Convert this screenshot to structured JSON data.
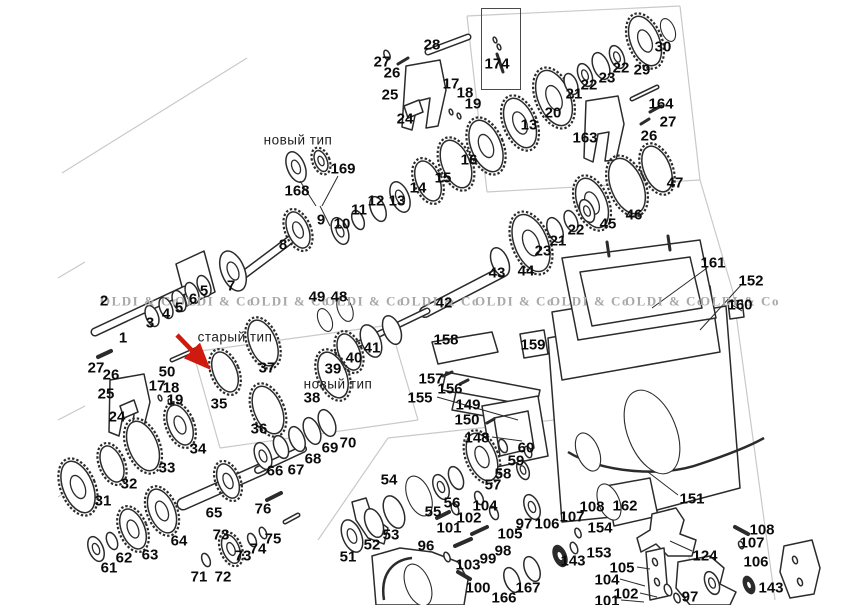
{
  "figure": {
    "width": 863,
    "height": 605,
    "background": "#ffffff",
    "line_color": "#2b2b2b",
    "label_color": "#0b0b0b",
    "watermark_color": "#a8a8a8",
    "section_line_color": "#c9c9c9",
    "arrow_color": "#cf1a10"
  },
  "watermark": {
    "text": "OLDI & Co",
    "y": 301,
    "xs": [
      100,
      175,
      250,
      325,
      400,
      475,
      550,
      625,
      700
    ]
  },
  "annotations": [
    {
      "text": "новый тип",
      "x": 298,
      "y": 140
    },
    {
      "text": "старый тип",
      "x": 235,
      "y": 337
    },
    {
      "text": "новый тип",
      "x": 338,
      "y": 384
    }
  ],
  "inset_box": {
    "part": "174",
    "x": 481,
    "y": 8,
    "w": 38,
    "h": 80
  },
  "red_arrow": {
    "x1": 177,
    "y1": 335,
    "x2": 205,
    "y2": 364
  },
  "callouts": [
    [
      "1",
      123,
      338
    ],
    [
      "2",
      104,
      301
    ],
    [
      "3",
      150,
      323
    ],
    [
      "4",
      166,
      314
    ],
    [
      "5",
      179,
      308
    ],
    [
      "6",
      193,
      299
    ],
    [
      "5",
      204,
      291
    ],
    [
      "7",
      231,
      286
    ],
    [
      "8",
      283,
      245
    ],
    [
      "168",
      297,
      191
    ],
    [
      "169",
      343,
      169
    ],
    [
      "9",
      321,
      220
    ],
    [
      "10",
      342,
      224
    ],
    [
      "11",
      359,
      210
    ],
    [
      "12",
      376,
      201
    ],
    [
      "13",
      397,
      201
    ],
    [
      "14",
      418,
      188
    ],
    [
      "15",
      443,
      178
    ],
    [
      "16",
      469,
      160
    ],
    [
      "27",
      382,
      62
    ],
    [
      "26",
      392,
      73
    ],
    [
      "25",
      390,
      95
    ],
    [
      "24",
      405,
      119
    ],
    [
      "28",
      432,
      45
    ],
    [
      "17",
      451,
      84
    ],
    [
      "18",
      465,
      93
    ],
    [
      "19",
      473,
      104
    ],
    [
      "13",
      529,
      125
    ],
    [
      "20",
      553,
      113
    ],
    [
      "174",
      497,
      64
    ],
    [
      "21",
      574,
      94
    ],
    [
      "22",
      589,
      85
    ],
    [
      "23",
      607,
      78
    ],
    [
      "22",
      621,
      68
    ],
    [
      "29",
      642,
      70
    ],
    [
      "30",
      663,
      47
    ],
    [
      "164",
      661,
      104
    ],
    [
      "27",
      668,
      122
    ],
    [
      "26",
      649,
      136
    ],
    [
      "163",
      585,
      138
    ],
    [
      "47",
      675,
      183
    ],
    [
      "46",
      634,
      215
    ],
    [
      "45",
      608,
      224
    ],
    [
      "49",
      317,
      297
    ],
    [
      "48",
      339,
      297
    ],
    [
      "42",
      444,
      303
    ],
    [
      "43",
      497,
      273
    ],
    [
      "44",
      526,
      271
    ],
    [
      "23",
      543,
      251
    ],
    [
      "21",
      558,
      241
    ],
    [
      "22",
      576,
      230
    ],
    [
      "39",
      333,
      369
    ],
    [
      "40",
      354,
      358
    ],
    [
      "41",
      372,
      348
    ],
    [
      "35",
      219,
      404
    ],
    [
      "37",
      267,
      368
    ],
    [
      "36",
      259,
      429
    ],
    [
      "38",
      312,
      398
    ],
    [
      "27",
      96,
      368
    ],
    [
      "26",
      111,
      375
    ],
    [
      "50",
      167,
      372
    ],
    [
      "25",
      106,
      394
    ],
    [
      "24",
      117,
      417
    ],
    [
      "17",
      157,
      386
    ],
    [
      "18",
      171,
      388
    ],
    [
      "19",
      175,
      400
    ],
    [
      "34",
      198,
      449
    ],
    [
      "33",
      167,
      468
    ],
    [
      "32",
      129,
      484
    ],
    [
      "31",
      103,
      501
    ],
    [
      "61",
      109,
      568
    ],
    [
      "62",
      124,
      558
    ],
    [
      "63",
      150,
      555
    ],
    [
      "64",
      179,
      541
    ],
    [
      "65",
      214,
      513
    ],
    [
      "66",
      275,
      471
    ],
    [
      "67",
      296,
      470
    ],
    [
      "68",
      313,
      459
    ],
    [
      "69",
      330,
      448
    ],
    [
      "70",
      348,
      443
    ],
    [
      "71",
      199,
      577
    ],
    [
      "72",
      223,
      577
    ],
    [
      "73",
      221,
      535
    ],
    [
      "73",
      243,
      556
    ],
    [
      "74",
      258,
      549
    ],
    [
      "75",
      273,
      539
    ],
    [
      "76",
      263,
      509
    ],
    [
      "51",
      348,
      557
    ],
    [
      "52",
      372,
      545
    ],
    [
      "53",
      391,
      535
    ],
    [
      "54",
      389,
      480
    ],
    [
      "55",
      433,
      512
    ],
    [
      "56",
      452,
      503
    ],
    [
      "57",
      493,
      485
    ],
    [
      "58",
      503,
      474
    ],
    [
      "96",
      426,
      546
    ],
    [
      "101",
      449,
      528
    ],
    [
      "102",
      469,
      518
    ],
    [
      "104",
      485,
      506
    ],
    [
      "105",
      510,
      534
    ],
    [
      "103",
      468,
      565
    ],
    [
      "99",
      488,
      559
    ],
    [
      "98",
      503,
      551
    ],
    [
      "100",
      478,
      588
    ],
    [
      "166",
      504,
      598
    ],
    [
      "167",
      528,
      588
    ],
    [
      "97",
      524,
      524
    ],
    [
      "106",
      547,
      524
    ],
    [
      "108",
      592,
      507
    ],
    [
      "107",
      572,
      517
    ],
    [
      "162",
      625,
      506
    ],
    [
      "151",
      692,
      499
    ],
    [
      "154",
      600,
      528
    ],
    [
      "153",
      599,
      553
    ],
    [
      "143",
      573,
      561
    ],
    [
      "105",
      622,
      568
    ],
    [
      "104",
      607,
      580
    ],
    [
      "102",
      626,
      594
    ],
    [
      "101",
      607,
      601
    ],
    [
      "124",
      705,
      556
    ],
    [
      "97",
      690,
      597
    ],
    [
      "108",
      762,
      530
    ],
    [
      "107",
      752,
      543
    ],
    [
      "106",
      756,
      562
    ],
    [
      "143",
      771,
      588
    ],
    [
      "158",
      446,
      340
    ],
    [
      "159",
      533,
      345
    ],
    [
      "157",
      431,
      379
    ],
    [
      "156",
      450,
      389
    ],
    [
      "155",
      420,
      398
    ],
    [
      "149",
      468,
      405
    ],
    [
      "150",
      467,
      420
    ],
    [
      "148",
      477,
      438
    ],
    [
      "60",
      526,
      448
    ],
    [
      "59",
      516,
      461
    ],
    [
      "161",
      713,
      263
    ],
    [
      "152",
      751,
      281
    ],
    [
      "160",
      740,
      305
    ]
  ],
  "drawing": {
    "rings": [
      [
        296,
        167,
        16,
        "b"
      ],
      [
        321,
        161,
        11,
        "g"
      ],
      [
        298,
        230,
        19,
        "g"
      ],
      [
        340,
        231,
        14,
        "b"
      ],
      [
        358,
        220,
        10,
        "r"
      ],
      [
        378,
        209,
        13,
        "r"
      ],
      [
        400,
        197,
        16,
        "b"
      ],
      [
        428,
        181,
        21,
        "t"
      ],
      [
        456,
        164,
        25,
        "t"
      ],
      [
        486,
        146,
        27,
        "g"
      ],
      [
        520,
        123,
        26,
        "g"
      ],
      [
        554,
        98,
        29,
        "g"
      ],
      [
        571,
        84,
        11,
        "r"
      ],
      [
        585,
        75,
        12,
        "b"
      ],
      [
        601,
        66,
        14,
        "r"
      ],
      [
        617,
        57,
        12,
        "b"
      ],
      [
        645,
        41,
        26,
        "g"
      ],
      [
        668,
        30,
        12,
        "n"
      ],
      [
        592,
        203,
        26,
        "g"
      ],
      [
        627,
        186,
        29,
        "t"
      ],
      [
        657,
        169,
        24,
        "t"
      ],
      [
        500,
        262,
        15,
        "r"
      ],
      [
        531,
        243,
        30,
        "g"
      ],
      [
        555,
        230,
        13,
        "r"
      ],
      [
        571,
        221,
        11,
        "r"
      ],
      [
        587,
        211,
        12,
        "b"
      ],
      [
        392,
        330,
        15,
        "r"
      ],
      [
        371,
        341,
        17,
        "r"
      ],
      [
        349,
        352,
        19,
        "t"
      ],
      [
        325,
        320,
        12,
        "n"
      ],
      [
        345,
        309,
        13,
        "n"
      ],
      [
        225,
        372,
        21,
        "t"
      ],
      [
        263,
        343,
        24,
        "t"
      ],
      [
        268,
        410,
        25,
        "t"
      ],
      [
        333,
        375,
        24,
        "t"
      ],
      [
        152,
        316,
        11,
        "r"
      ],
      [
        166,
        308,
        11,
        "r"
      ],
      [
        179,
        301,
        11,
        "r"
      ],
      [
        192,
        293,
        11,
        "r"
      ],
      [
        204,
        286,
        11,
        "r"
      ],
      [
        233,
        271,
        21,
        "b"
      ],
      [
        180,
        425,
        21,
        "g"
      ],
      [
        143,
        446,
        26,
        "t"
      ],
      [
        112,
        464,
        19,
        "t"
      ],
      [
        78,
        487,
        27,
        "g"
      ],
      [
        96,
        549,
        13,
        "b"
      ],
      [
        112,
        541,
        9,
        "r"
      ],
      [
        133,
        529,
        21,
        "g"
      ],
      [
        162,
        511,
        23,
        "g"
      ],
      [
        228,
        481,
        18,
        "g"
      ],
      [
        263,
        456,
        14,
        "b"
      ],
      [
        281,
        447,
        12,
        "r"
      ],
      [
        297,
        439,
        13,
        "r"
      ],
      [
        312,
        431,
        14,
        "r"
      ],
      [
        327,
        423,
        14,
        "r"
      ],
      [
        206,
        560,
        7,
        "r"
      ],
      [
        231,
        549,
        15,
        "g"
      ],
      [
        252,
        540,
        7,
        "r"
      ],
      [
        263,
        533,
        6,
        "r"
      ],
      [
        352,
        536,
        17,
        "b"
      ],
      [
        374,
        523,
        15,
        "r"
      ],
      [
        394,
        512,
        17,
        "r"
      ],
      [
        419,
        496,
        21,
        "n"
      ],
      [
        441,
        487,
        13,
        "b"
      ],
      [
        456,
        478,
        12,
        "r"
      ],
      [
        482,
        457,
        25,
        "g"
      ],
      [
        503,
        446,
        7,
        "r"
      ],
      [
        532,
        507,
        13,
        "b"
      ],
      [
        455,
        509,
        6,
        "r"
      ],
      [
        479,
        498,
        7,
        "r"
      ],
      [
        494,
        513,
        7,
        "r"
      ],
      [
        447,
        557,
        5,
        "r"
      ],
      [
        512,
        580,
        13,
        "r"
      ],
      [
        532,
        569,
        13,
        "r"
      ],
      [
        560,
        556,
        11,
        "d"
      ],
      [
        574,
        548,
        6,
        "r"
      ],
      [
        578,
        533,
        5,
        "r"
      ],
      [
        523,
        470,
        10,
        "b"
      ],
      [
        528,
        452,
        6,
        "r"
      ],
      [
        749,
        585,
        9,
        "d"
      ],
      [
        741,
        545,
        4,
        "r"
      ],
      [
        668,
        590,
        6,
        "r"
      ],
      [
        677,
        598,
        5,
        "r"
      ],
      [
        652,
        432,
        44,
        "n"
      ],
      [
        588,
        452,
        20,
        "n"
      ],
      [
        609,
        502,
        19,
        "n"
      ],
      [
        418,
        585,
        22,
        "n"
      ],
      [
        712,
        583,
        12,
        "b"
      ],
      [
        387,
        55,
        5,
        "r"
      ],
      [
        451,
        112,
        3,
        "r"
      ],
      [
        459,
        116,
        3,
        "r"
      ],
      [
        160,
        398,
        3,
        "r"
      ],
      [
        170,
        402,
        3,
        "r"
      ],
      [
        495,
        40,
        3,
        "r"
      ],
      [
        499,
        47,
        3,
        "r"
      ],
      [
        795,
        560,
        4,
        "r"
      ],
      [
        800,
        582,
        4,
        "r"
      ],
      [
        655,
        562,
        4,
        "r"
      ],
      [
        657,
        582,
        4,
        "r"
      ]
    ],
    "shafts": [
      [
        95,
        332,
        185,
        290,
        9
      ],
      [
        238,
        279,
        302,
        231,
        9
      ],
      [
        428,
        52,
        468,
        37,
        7
      ],
      [
        632,
        99,
        657,
        87,
        5
      ],
      [
        172,
        360,
        197,
        349,
        5
      ],
      [
        98,
        357,
        111,
        351,
        4
      ],
      [
        425,
        312,
        502,
        272,
        12
      ],
      [
        352,
        347,
        427,
        311,
        7
      ],
      [
        183,
        504,
        262,
        469,
        13
      ],
      [
        258,
        470,
        303,
        449,
        8
      ],
      [
        285,
        522,
        298,
        515,
        5
      ],
      [
        267,
        500,
        281,
        493,
        4
      ],
      [
        437,
        518,
        449,
        512,
        4
      ],
      [
        472,
        534,
        487,
        527,
        4
      ],
      [
        455,
        546,
        471,
        539,
        4
      ],
      [
        458,
        572,
        470,
        579,
        4
      ],
      [
        735,
        527,
        748,
        534,
        4
      ],
      [
        398,
        64,
        408,
        58,
        3
      ],
      [
        650,
        112,
        661,
        106,
        3
      ],
      [
        641,
        124,
        649,
        119,
        3
      ],
      [
        443,
        376,
        452,
        372,
        3
      ],
      [
        460,
        384,
        468,
        380,
        3
      ],
      [
        487,
        423,
        494,
        419,
        3
      ],
      [
        497,
        54,
        503,
        72,
        3
      ],
      [
        607,
        242,
        609,
        256,
        3
      ],
      [
        668,
        236,
        670,
        250,
        3
      ]
    ],
    "outlines": [
      "M548,338 L726,306 L740,488 L642,514 L562,522 Z",
      "M552,312 L710,286 L720,352 L562,380 Z",
      "M562,258 L700,240 L716,318 L578,340 Z",
      "M580,272 L690,257 L702,308 L592,326 Z",
      "M406,66 L440,60 L446,90 L438,126 L426,128 L430,98 L418,101 L412,130 L402,127 Z",
      "M404,106 L419,100 L423,112 L408,118 Z",
      "M586,101 L618,96 L624,124 L616,160 L605,161 L609,132 L598,134 L593,162 L584,158 Z",
      "M110,380 L144,374 L150,402 L142,434 L131,435 L135,408 L124,410 L119,436 L109,432 Z",
      "M120,406 L134,400 L138,412 L124,418 Z",
      "M176,264 L204,251 L215,292 L187,306 Z",
      "M432,342 L492,332 L498,352 L438,364 Z",
      "M446,372 L540,390 L536,408 L442,390 Z",
      "M456,392 L522,404 L518,422 L452,410 Z",
      "M482,406 L538,396 L548,456 L492,468 Z",
      "M494,418 L528,411 L534,448 L500,456 Z",
      "M520,334 L544,330 L548,354 L524,358 Z",
      "M728,302 L742,300 L744,317 L730,319 Z",
      "M606,486 L650,478 L658,516 L614,526 Z",
      "M652,514 L676,508 L684,520 L680,534 L696,540 L692,556 L668,556 L656,544 L641,552 L637,538 L650,530 Z",
      "M678,562 L710,556 L724,568 L720,584 L736,592 L730,605 L690,605 L676,588 Z",
      "M784,546 L812,540 L820,568 L814,594 L790,598 L780,572 Z",
      "M646,552 L664,548 L668,596 L650,600 Z",
      "M372,556 L400,548 L432,552 L458,562 L468,580 L464,605 L376,605 Z",
      "M352,502 L366,498 L372,516 L388,528 L384,544 L368,538 L356,520 Z"
    ],
    "curves": [
      "M568,452 C600,472 662,478 700,464 C730,454 750,446 764,438",
      "M384,600 C380,575 392,560 412,558"
    ],
    "grays": [
      [
        62,
        173,
        247,
        58
      ],
      [
        58,
        278,
        85,
        262
      ],
      [
        58,
        497,
        80,
        483
      ],
      [
        58,
        420,
        85,
        406
      ],
      [
        467,
        16,
        680,
        6
      ],
      [
        680,
        6,
        700,
        180
      ],
      [
        467,
        16,
        487,
        192
      ],
      [
        487,
        192,
        700,
        180
      ],
      [
        700,
        180,
        733,
        292
      ],
      [
        193,
        352,
        390,
        325
      ],
      [
        390,
        325,
        418,
        420
      ],
      [
        193,
        352,
        220,
        448
      ],
      [
        220,
        448,
        418,
        420
      ],
      [
        318,
        540,
        388,
        438
      ],
      [
        388,
        438,
        628,
        412
      ],
      [
        628,
        412,
        706,
        598
      ],
      [
        733,
        292,
        775,
        600
      ]
    ],
    "leaders": [
      [
        300,
        181,
        316,
        206
      ],
      [
        338,
        176,
        322,
        206
      ],
      [
        320,
        206,
        330,
        226
      ],
      [
        437,
        397,
        518,
        420
      ],
      [
        492,
        437,
        522,
        441
      ],
      [
        707,
        268,
        652,
        308
      ],
      [
        742,
        284,
        700,
        330
      ],
      [
        732,
        305,
        742,
        311
      ],
      [
        678,
        495,
        648,
        472
      ],
      [
        692,
        551,
        670,
        541
      ],
      [
        637,
        567,
        650,
        569
      ],
      [
        620,
        579,
        645,
        586
      ],
      [
        640,
        593,
        657,
        597
      ],
      [
        621,
        600,
        644,
        602
      ]
    ]
  }
}
